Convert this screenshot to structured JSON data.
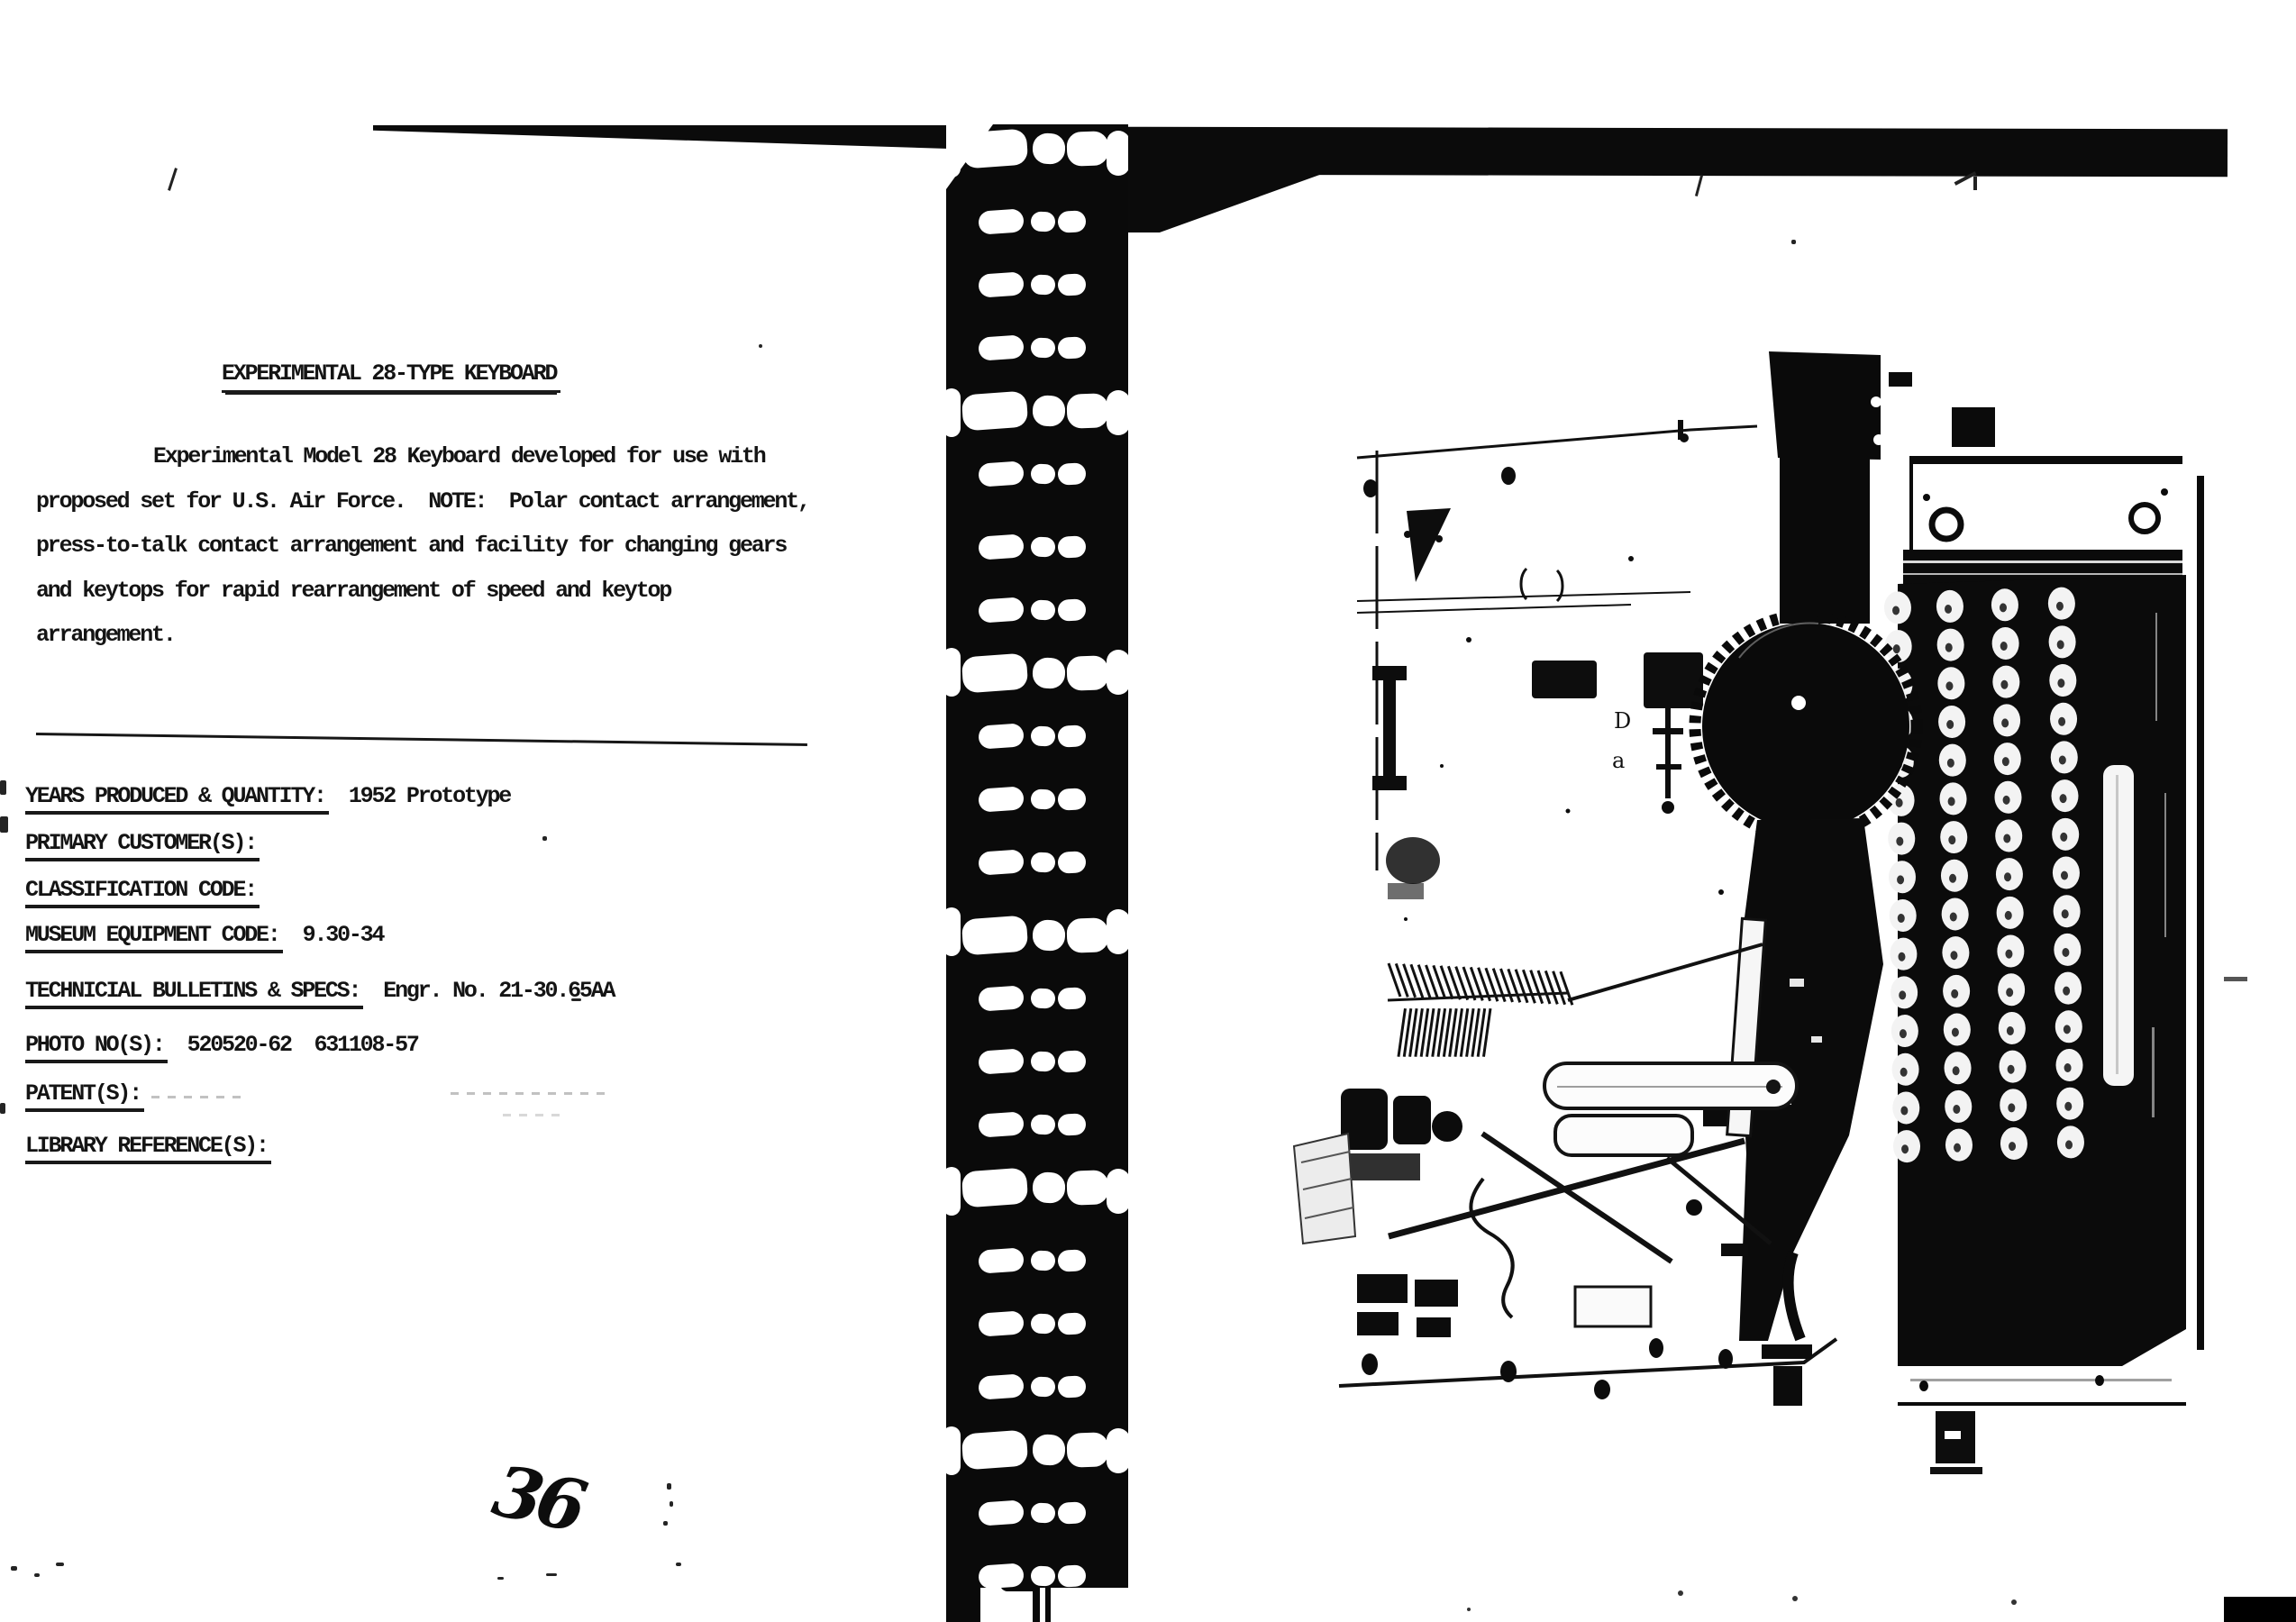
{
  "document": {
    "title": "EXPERIMENTAL 28-TYPE KEYBOARD",
    "paragraph_lines": [
      "Experimental Model 28 Keyboard developed for use with",
      "proposed set for U.S. Air Force.  NOTE:  Polar contact arrangement,",
      "press-to-talk contact arrangement and facility for changing gears",
      "and keytops for rapid rearrangement of speed and keytop",
      "arrangement."
    ],
    "fields": [
      {
        "label": "YEARS PRODUCED & QUANTITY:",
        "value": "1952 Prototype"
      },
      {
        "label": "PRIMARY CUSTOMER(S):",
        "value": ""
      },
      {
        "label": "CLASSIFICATION CODE:",
        "value": ""
      },
      {
        "label": "MUSEUM EQUIPMENT CODE:",
        "value": "9.30-34"
      },
      {
        "label": "TECHNICIAL BULLETINS & SPECS:",
        "value": "Engr. No. 21-30.65AA"
      },
      {
        "label": "PHOTO NO(S):",
        "value": "520520-62  631108-57"
      },
      {
        "label": "PATENT(S):",
        "value": ""
      },
      {
        "label": "LIBRARY REFERENCE(S):",
        "value": ""
      }
    ],
    "page_number": "36"
  },
  "colors": {
    "ink": "#141414",
    "paper": "#ffffff",
    "photo_black": "#0b0b0b"
  }
}
